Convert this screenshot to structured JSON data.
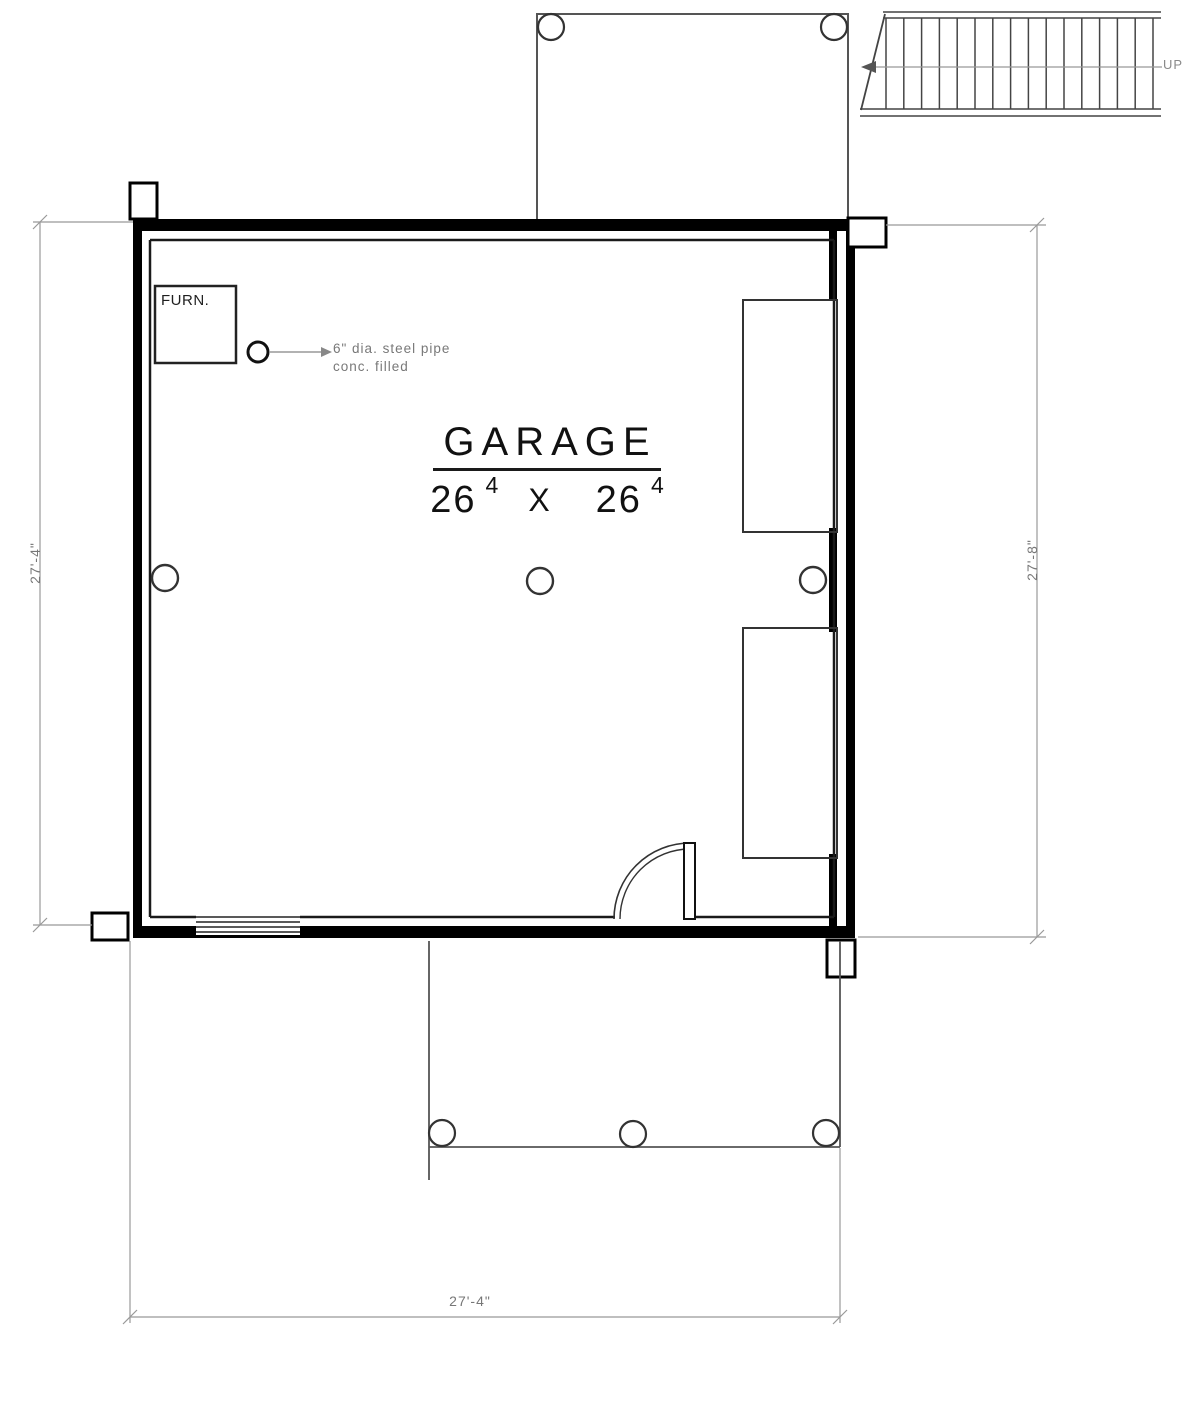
{
  "drawing": {
    "room_label": "GARAGE",
    "size": {
      "left_feet": "26",
      "left_inches_sup": "4",
      "separator": "X",
      "right_feet": "26",
      "right_inches_sup": "4"
    },
    "furnace_label": "FURN.",
    "pipe_note_line1": "6\" dia. steel pipe",
    "pipe_note_line2": "conc. filled",
    "stairs_direction_label": "UP",
    "dimensions": {
      "left": "27'-4\"",
      "right": "27'-8\"",
      "bottom": "27'-4\""
    },
    "colors": {
      "wall": "#000000",
      "thin_line": "#333333",
      "light_line": "#555555",
      "dimension_line": "#999999",
      "paper": "#ffffff"
    }
  }
}
